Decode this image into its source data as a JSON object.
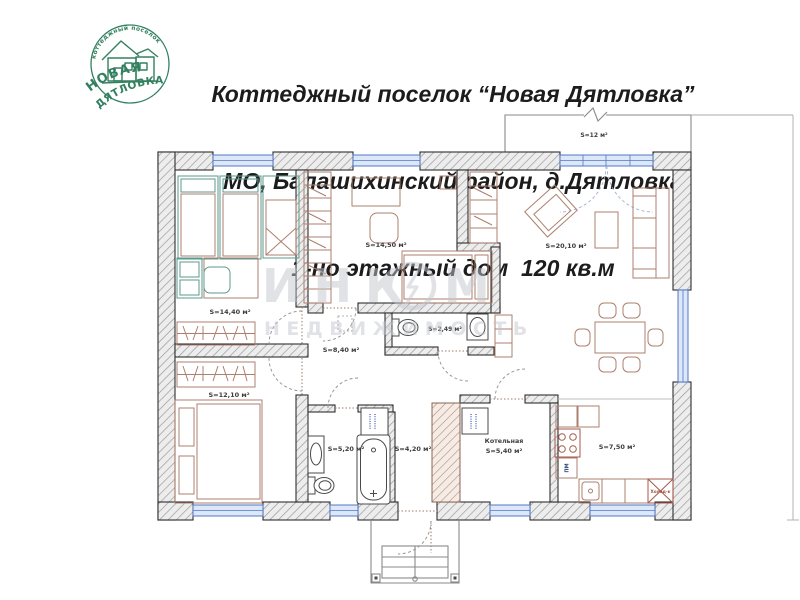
{
  "header": {
    "line1": "Коттеджный поселок “Новая Дятловка”",
    "line2": "МО, Балашихинский район, д.Дятловка",
    "line3": "1-но этажный дом  120 кв.м"
  },
  "logo": {
    "arc_text": "коттеджный поселок",
    "name_top": "НОВАЯ",
    "name_bottom": "ДЯТЛОВКА"
  },
  "watermark": {
    "word_part1": "ИНК",
    "word_part2": "М",
    "line2": "НЕДВИЖИМОСТЬ"
  },
  "plan": {
    "rooms": {
      "bedroom1": {
        "area": "S=14,40 м²"
      },
      "bedroom2": {
        "area": "S=14,50 м²"
      },
      "living": {
        "area": "S=20,10 м²"
      },
      "terrace": {
        "area": "S=12 м²"
      },
      "bedroom3": {
        "area": "S=12,10 м²"
      },
      "corridor": {
        "area": "S=8,40 м²"
      },
      "wc": {
        "area": "S=2,49 м²"
      },
      "bathroom": {
        "area": "S=5,20 м²"
      },
      "hall": {
        "area": "S=4,20 м²"
      },
      "boiler": {
        "name": "Котельная",
        "area": "S=5,40 м²"
      },
      "kitchen": {
        "area": "S=7,50 м²"
      }
    },
    "appliances": {
      "fridge": "Холод-к",
      "dishwasher": "ПМ"
    }
  },
  "colors": {
    "logo_green": "#338060",
    "title_text": "#1c1c1c",
    "wall_outline": "#2e2e2e",
    "window_blue": "#4f79c4",
    "furniture_brown": "#ad7f6d",
    "furniture_green": "#5a9a8b",
    "stove_red": "#a65a4a",
    "watermark_gray": "#c2c6cc",
    "appliance_blue": "#27406e"
  }
}
